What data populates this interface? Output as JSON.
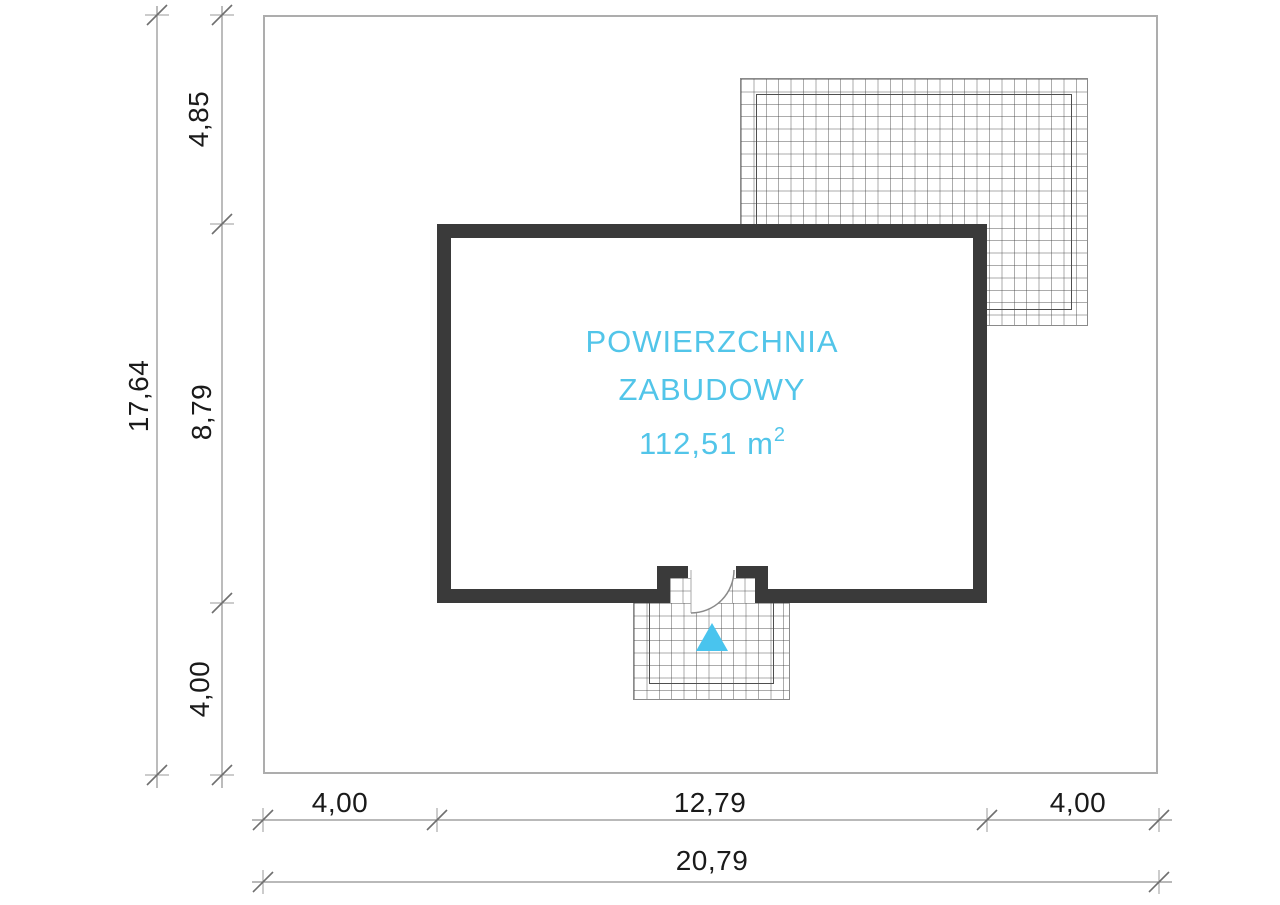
{
  "drawing": {
    "building_label": {
      "line1": "POWIERZCHNIA",
      "line2": "ZABUDOWY",
      "area_value": "112,51 m",
      "area_exponent": "2"
    },
    "dimensions": {
      "site_height": "17,64",
      "setback_top": "4,85",
      "building_depth": "8,79",
      "setback_bottom": "4,00",
      "setback_left": "4,00",
      "building_width": "12,79",
      "setback_right": "4,00",
      "site_width": "20,79"
    },
    "colors": {
      "accent_cyan": "#52c5e9",
      "triangle_cyan": "#49c4ee",
      "wall_dark": "#3a3a3a",
      "dimension_line_gray": "#8f8f8f",
      "boundary_gray": "#adadad",
      "text_black": "#1a1a1a"
    }
  }
}
